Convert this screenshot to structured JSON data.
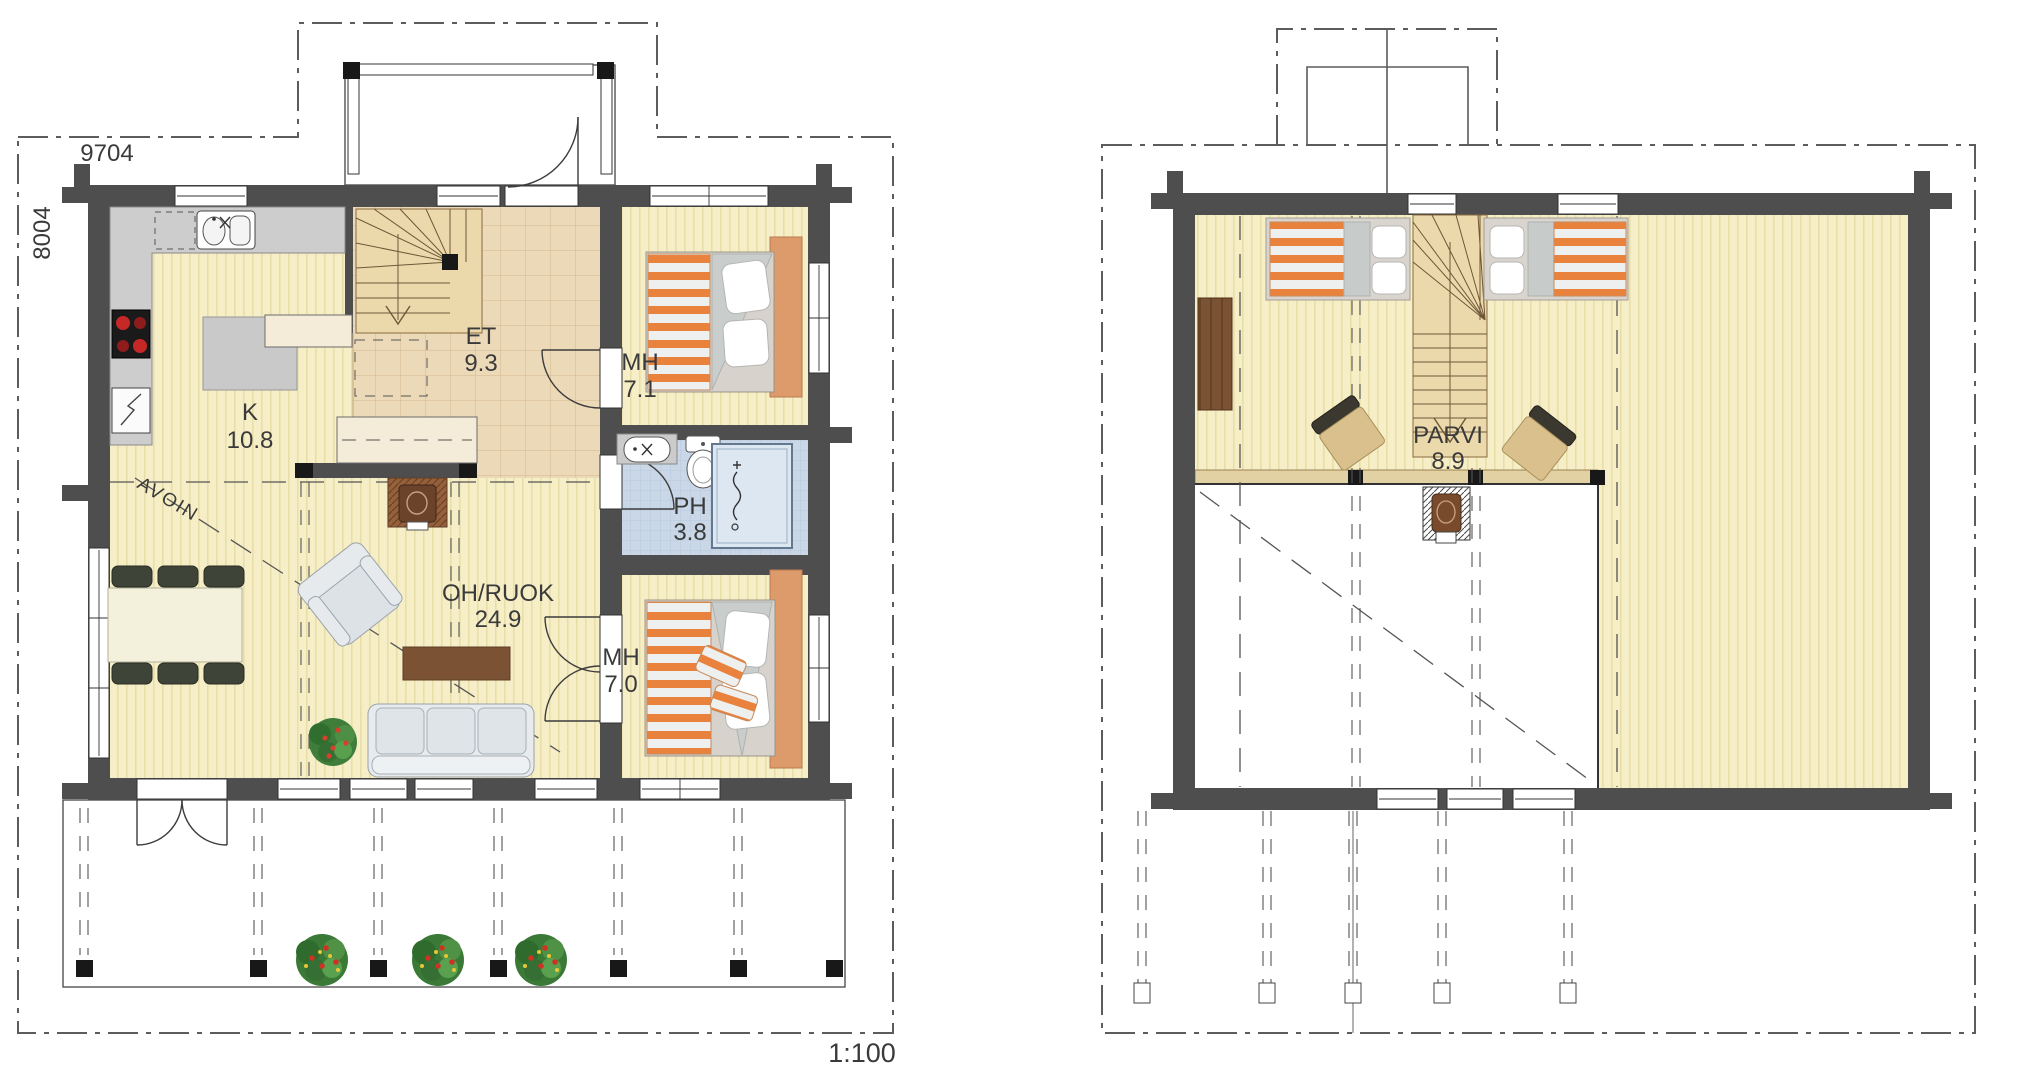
{
  "plan": {
    "scale_label": "1:100",
    "ground_floor": {
      "dim_width": "9704",
      "dim_height": "8004",
      "open_annotation": "AVOIN",
      "rooms": {
        "kitchen": {
          "label": "K",
          "area": "10.8"
        },
        "entry": {
          "label": "ET",
          "area": "9.3"
        },
        "bedroom_top": {
          "label": "MH",
          "area": "7.1"
        },
        "bathroom": {
          "label": "PH",
          "area": "3.8"
        },
        "living_dining": {
          "label": "OH/RUOK",
          "area": "24.9"
        },
        "bedroom_bottom": {
          "label": "MH",
          "area": "7.0"
        }
      }
    },
    "upper_floor": {
      "rooms": {
        "loft": {
          "label": "PARVI",
          "area": "8.9"
        }
      }
    }
  },
  "colors": {
    "wall": "#4e4e4e",
    "floor": "#f6eec6",
    "floorStripe": "#e9dda8",
    "tile": "#ecd9b8",
    "tileLine": "#d2b68c",
    "wet": "#c9d7e7",
    "wetLine": "#b4c6da",
    "deck": "#a9b288",
    "deckLine": "#8d996c",
    "orange": "#e8823c",
    "wood": "#7b5334",
    "ink": "#3a3a3a"
  }
}
